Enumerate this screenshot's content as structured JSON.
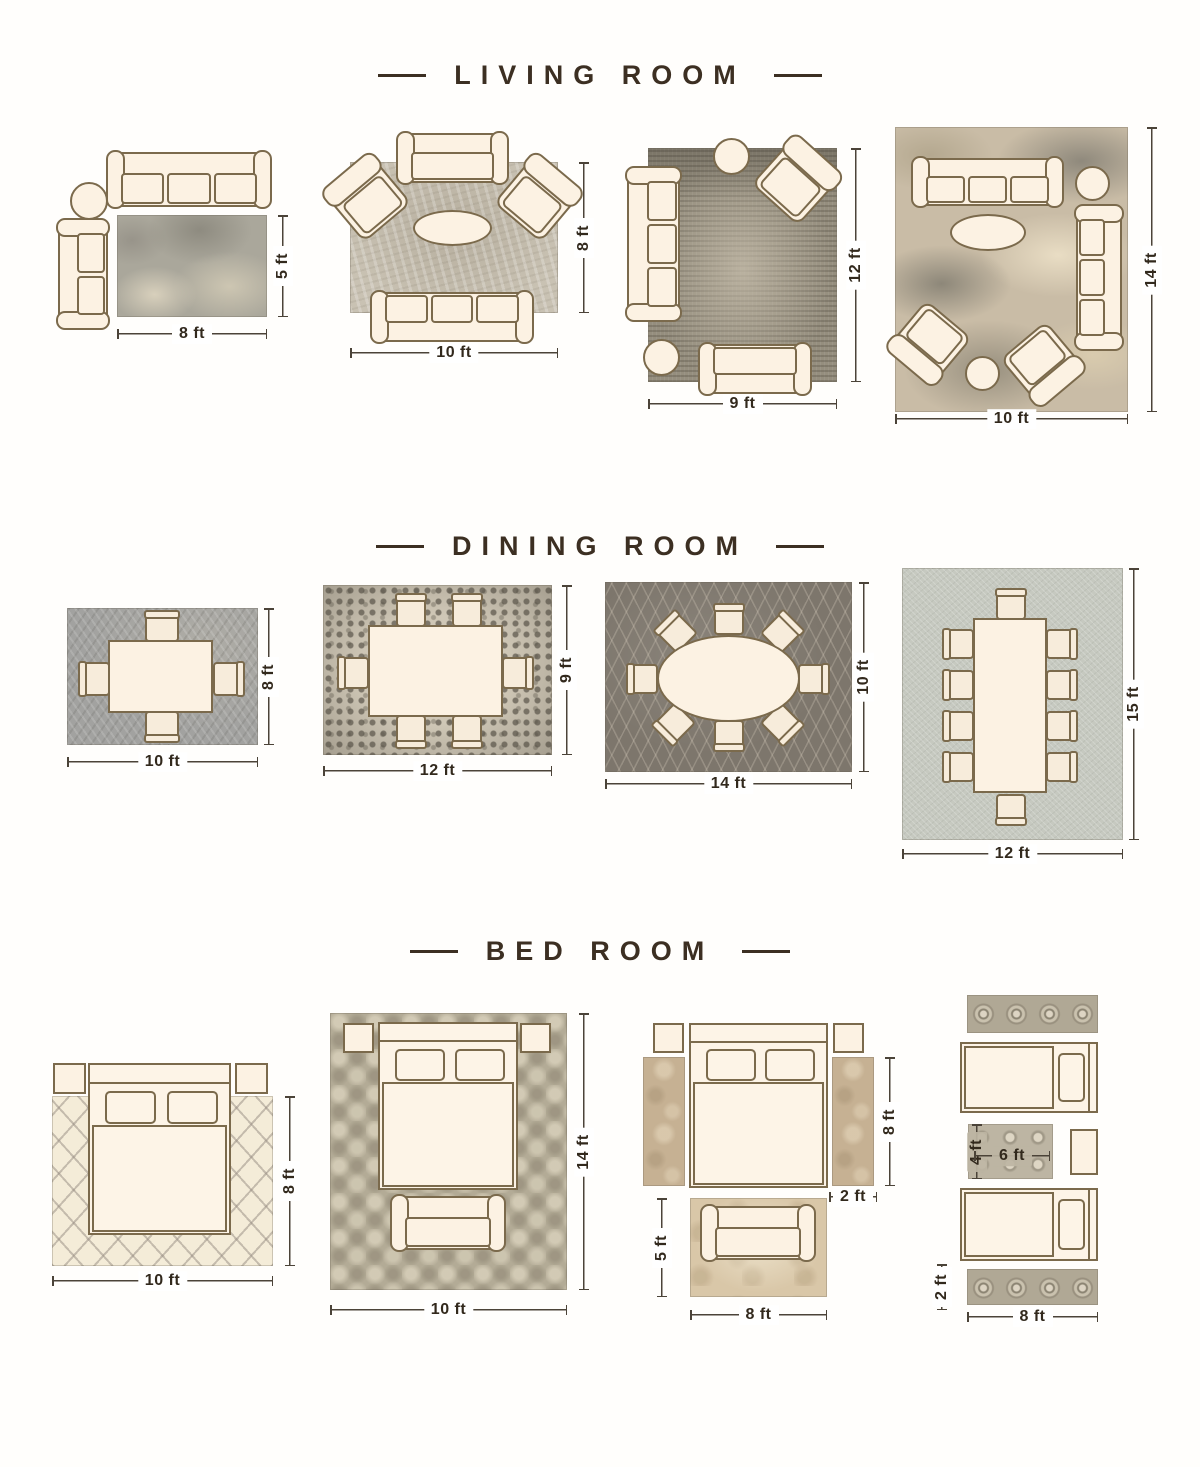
{
  "colors": {
    "background": "#ffffff",
    "heading_text": "#3c2f22",
    "dimension_text": "#32291d",
    "furniture_fill": "#fcf2e3",
    "furniture_outline": "#7b6a4c"
  },
  "sections": [
    {
      "title": "LIVING ROOM",
      "layouts": [
        {
          "name": "living-8x5",
          "width": "8 ft",
          "height": "5 ft"
        },
        {
          "name": "living-10x8",
          "width": "10 ft",
          "height": "8 ft"
        },
        {
          "name": "living-9x12",
          "width": "9 ft",
          "height": "12 ft"
        },
        {
          "name": "living-10x14",
          "width": "10 ft",
          "height": "14 ft"
        }
      ]
    },
    {
      "title": "DINING ROOM",
      "layouts": [
        {
          "name": "dining-10x8",
          "width": "10 ft",
          "height": "8 ft"
        },
        {
          "name": "dining-12x9",
          "width": "12 ft",
          "height": "9 ft"
        },
        {
          "name": "dining-14x10",
          "width": "14 ft",
          "height": "10 ft"
        },
        {
          "name": "dining-12x15",
          "width": "12 ft",
          "height": "15 ft"
        }
      ]
    },
    {
      "title": "BED ROOM",
      "layouts": [
        {
          "name": "bed-10x8",
          "width": "10 ft",
          "height": "8 ft"
        },
        {
          "name": "bed-10x14",
          "width": "10 ft",
          "height": "14 ft"
        },
        {
          "name": "bed-side-runners",
          "runner_height": "8 ft",
          "runner_width": "2 ft",
          "front_rug_height": "5 ft",
          "front_rug_width": "8 ft"
        },
        {
          "name": "bed-twin-runners",
          "center_rug_height": "4 ft",
          "center_rug_width": "6 ft",
          "runner_height": "2 ft",
          "layout_width": "8 ft"
        }
      ]
    }
  ]
}
